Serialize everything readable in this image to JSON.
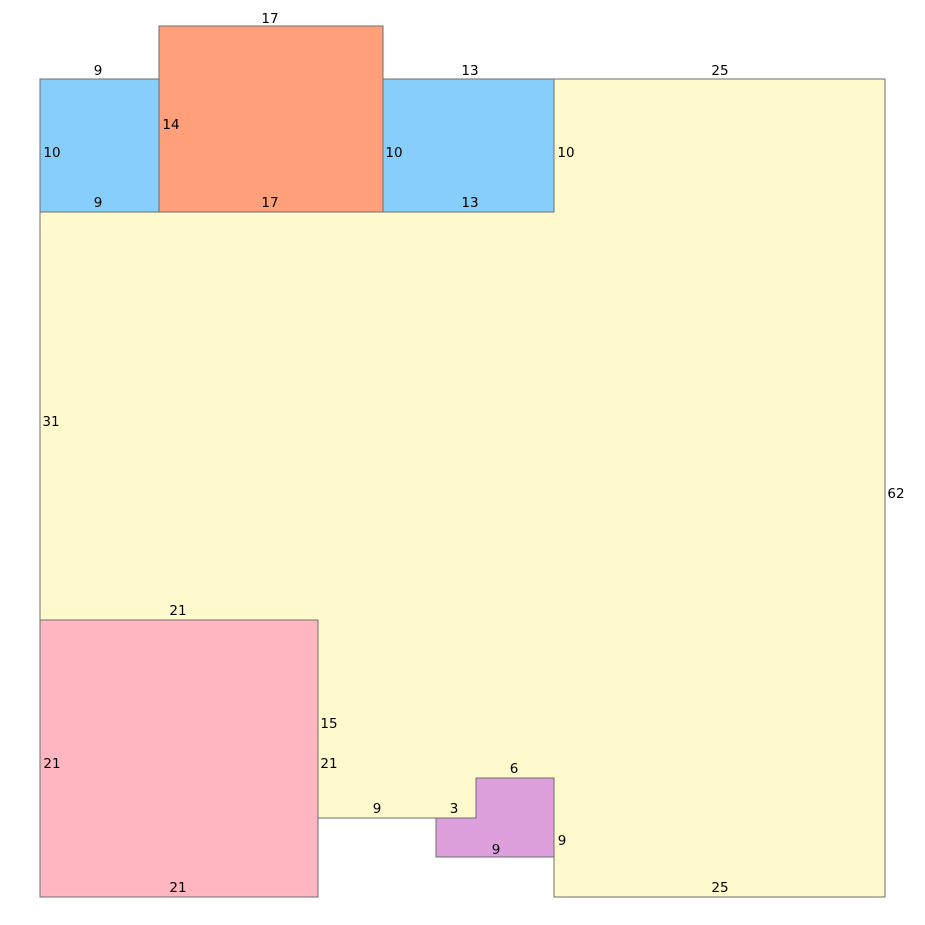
{
  "canvas": {
    "width": 925,
    "height": 925
  },
  "colors": {
    "background": "#ffffff",
    "stroke": "#6e6e6e",
    "label_text": "#000000",
    "yellow": "#fffacd",
    "blue": "#87cefa",
    "salmon": "#ffa07a",
    "pink": "#ffb6c1",
    "plum": "#dda0dd"
  },
  "shapes": [
    {
      "name": "yellow-polygon",
      "color": "yellow",
      "points": [
        [
          40,
          212
        ],
        [
          554,
          212
        ],
        [
          554,
          79
        ],
        [
          885,
          79
        ],
        [
          885,
          897
        ],
        [
          554,
          897
        ],
        [
          554,
          778
        ],
        [
          476,
          778
        ],
        [
          476,
          818
        ],
        [
          318,
          818
        ],
        [
          318,
          620
        ],
        [
          40,
          620
        ]
      ]
    },
    {
      "name": "blue-rect-left",
      "color": "blue",
      "points": [
        [
          40,
          79
        ],
        [
          159,
          79
        ],
        [
          159,
          212
        ],
        [
          40,
          212
        ]
      ]
    },
    {
      "name": "salmon-rect",
      "color": "salmon",
      "points": [
        [
          159,
          26
        ],
        [
          383,
          26
        ],
        [
          383,
          212
        ],
        [
          159,
          212
        ]
      ]
    },
    {
      "name": "blue-rect-right",
      "color": "blue",
      "points": [
        [
          383,
          79
        ],
        [
          554,
          79
        ],
        [
          554,
          212
        ],
        [
          383,
          212
        ]
      ]
    },
    {
      "name": "pink-rect",
      "color": "pink",
      "points": [
        [
          40,
          620
        ],
        [
          318,
          620
        ],
        [
          318,
          897
        ],
        [
          40,
          897
        ]
      ]
    },
    {
      "name": "plum-l-shape",
      "color": "plum",
      "points": [
        [
          476,
          778
        ],
        [
          554,
          778
        ],
        [
          554,
          857
        ],
        [
          436,
          857
        ],
        [
          436,
          818
        ],
        [
          476,
          818
        ]
      ]
    }
  ],
  "labels": [
    {
      "text": "17",
      "x": 270,
      "y": 18
    },
    {
      "text": "9",
      "x": 98,
      "y": 70
    },
    {
      "text": "13",
      "x": 470,
      "y": 70
    },
    {
      "text": "25",
      "x": 720,
      "y": 70
    },
    {
      "text": "14",
      "x": 171,
      "y": 124
    },
    {
      "text": "10",
      "x": 52,
      "y": 152
    },
    {
      "text": "10",
      "x": 394,
      "y": 152
    },
    {
      "text": "10",
      "x": 566,
      "y": 152
    },
    {
      "text": "9",
      "x": 98,
      "y": 202
    },
    {
      "text": "17",
      "x": 270,
      "y": 202
    },
    {
      "text": "13",
      "x": 470,
      "y": 202
    },
    {
      "text": "31",
      "x": 51,
      "y": 421
    },
    {
      "text": "62",
      "x": 896,
      "y": 493
    },
    {
      "text": "21",
      "x": 178,
      "y": 610
    },
    {
      "text": "15",
      "x": 329,
      "y": 723
    },
    {
      "text": "21",
      "x": 52,
      "y": 763
    },
    {
      "text": "21",
      "x": 329,
      "y": 763
    },
    {
      "text": "9",
      "x": 377,
      "y": 808
    },
    {
      "text": "3",
      "x": 454,
      "y": 808
    },
    {
      "text": "6",
      "x": 514,
      "y": 768
    },
    {
      "text": "9",
      "x": 496,
      "y": 849
    },
    {
      "text": "9",
      "x": 562,
      "y": 840
    },
    {
      "text": "21",
      "x": 178,
      "y": 887
    },
    {
      "text": "25",
      "x": 720,
      "y": 887
    }
  ]
}
